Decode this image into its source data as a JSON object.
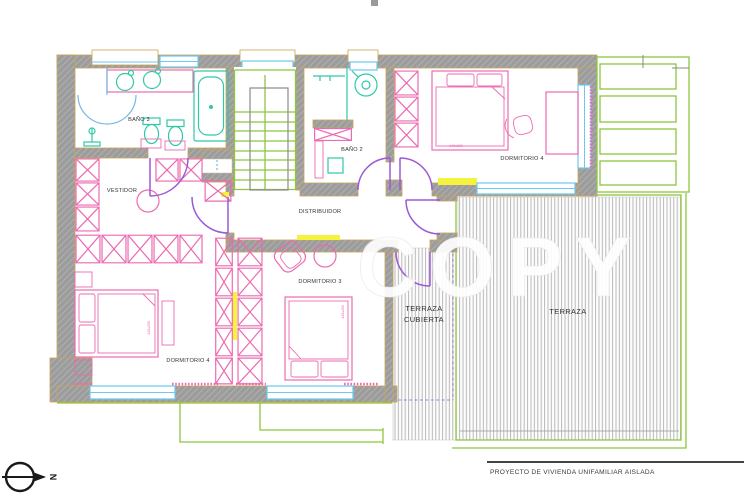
{
  "title_block": {
    "project_title": "PROYECTO  DE VIVIENDA UNIFAMILIAR AISLADA"
  },
  "compass": {
    "label": "N"
  },
  "watermark": {
    "text": "COPY"
  },
  "rooms": {
    "bano3": "BAÑO 3",
    "bano2": "BAÑO 2",
    "vestidor": "VESTIDOR",
    "distribuidor": "DISTRIBUIDOR",
    "dormitorio3": "DORMITORIO 3",
    "dormitorio4_left": "DORMITORIO 4",
    "dormitorio4_right": "DORMITORIO 4",
    "terraza_cubierta_line1": "TERRAZA",
    "terraza_cubierta_line2": "CUBIERTA",
    "terraza": "TERRAZA"
  },
  "bed_labels": {
    "bed1": "140x200",
    "bed2": "140x200",
    "bed3": "140x200"
  },
  "colors": {
    "wall_gray": "#9c9c9c",
    "outline_tan": "#c9a455",
    "furniture_pink": "#ec6ab1",
    "fixture_teal": "#2fc9a8",
    "door_purple": "#9b59d6",
    "door_blue": "#74b6e4",
    "window_cyan": "#6cc9ef",
    "stair_green": "#8cc63f",
    "highlight_yellow": "#f6f33e"
  }
}
